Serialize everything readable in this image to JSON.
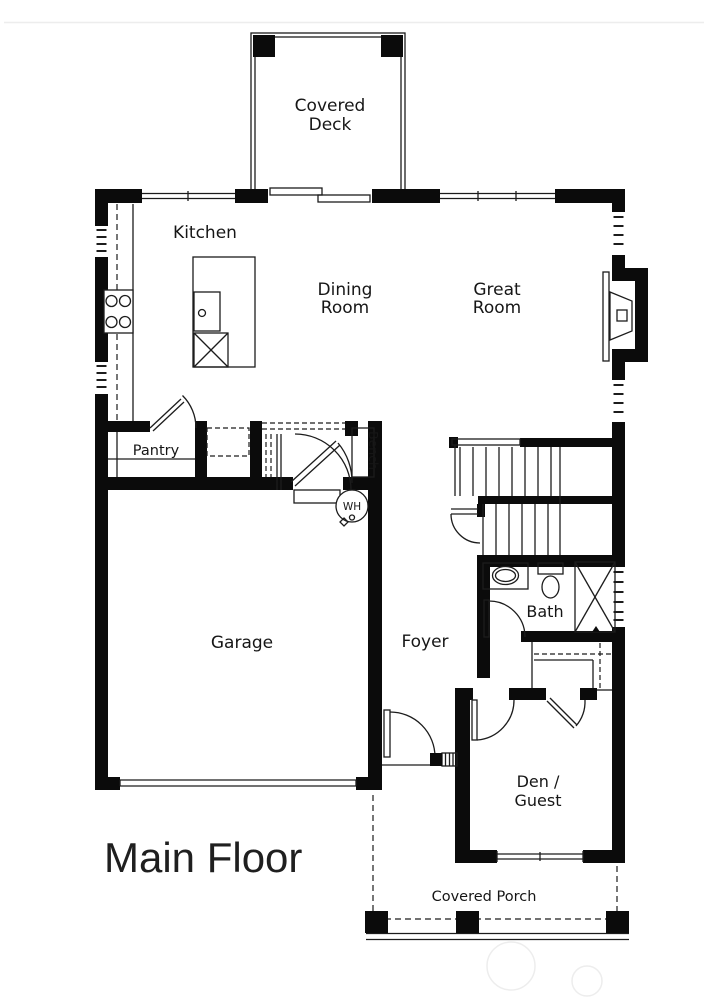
{
  "title": "Main Floor",
  "floor_plan": {
    "rooms": {
      "covered_deck": [
        "Covered",
        "Deck"
      ],
      "kitchen": "Kitchen",
      "dining_room": [
        "Dining",
        "Room"
      ],
      "great_room": [
        "Great",
        "Room"
      ],
      "pantry": "Pantry",
      "bench": "Bench",
      "garage": "Garage",
      "foyer": "Foyer",
      "bath": "Bath",
      "den_guest": [
        "Den /",
        "Guest"
      ],
      "covered_porch": "Covered Porch"
    },
    "fixtures": {
      "water_heater": "WH"
    }
  },
  "colors": {
    "wall": "#0b0b0b",
    "line": "#1c1c1c",
    "text": "#161616",
    "title": "#1f1f1f",
    "faint": "#ededed"
  }
}
